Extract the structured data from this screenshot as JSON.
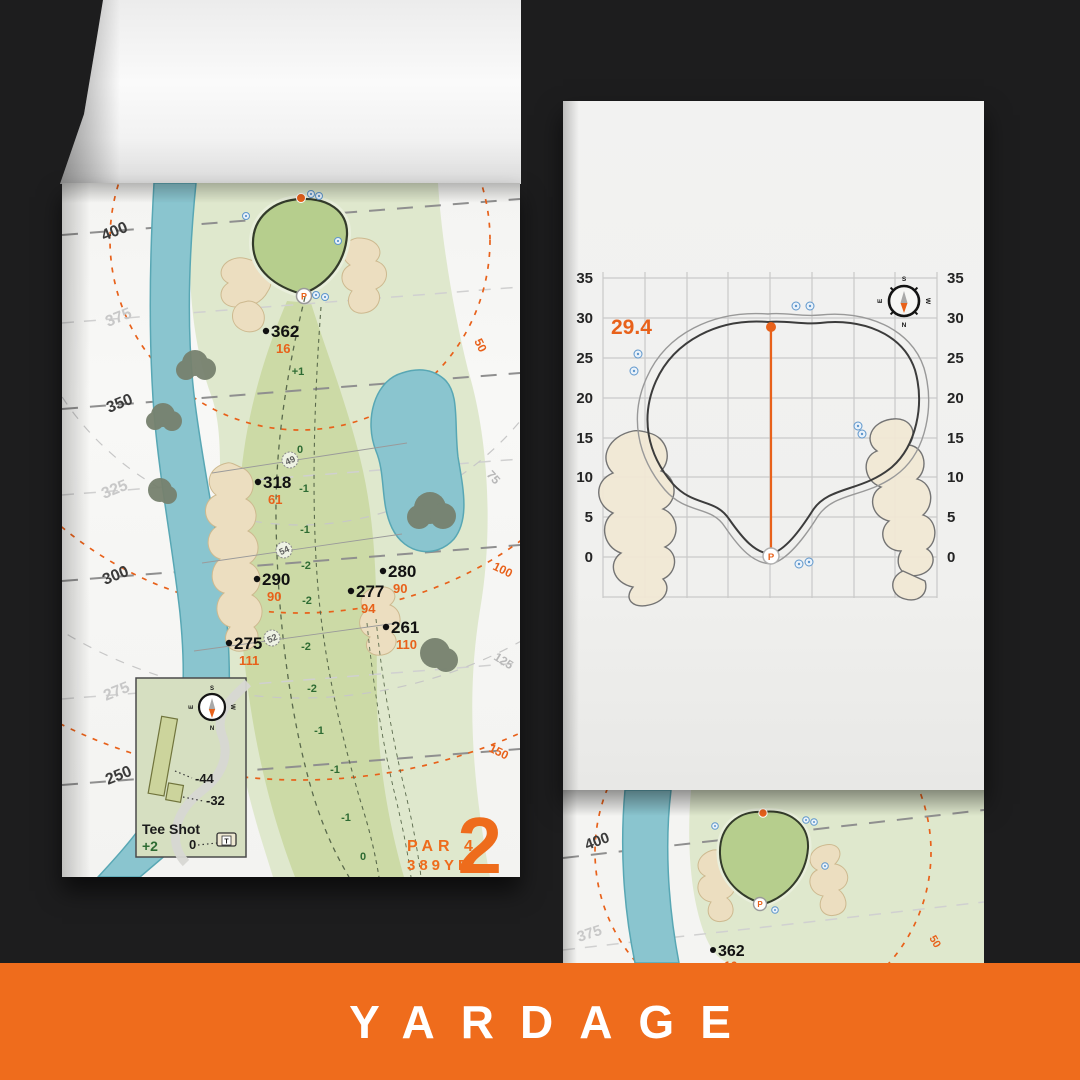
{
  "banner": {
    "title": "YARDAGE"
  },
  "palette": {
    "accent_orange": "#ee6c1c",
    "paper": "#f4f4f2",
    "fairway": "#ccdaa6",
    "rough": "#dfe8cd",
    "green": "#b6ce8d",
    "water": "#8ac5cf",
    "bunker": "#ecdec0",
    "slope_text": "#2e6b33"
  },
  "compass": {
    "n": "N",
    "s": "S",
    "e": "E",
    "w": "W"
  },
  "glyphs": {
    "pin": "P",
    "tee": "T"
  },
  "hole_page": {
    "side_yardages": [
      {
        "label": "400"
      },
      {
        "label": "375"
      },
      {
        "label": "350"
      },
      {
        "label": "325"
      },
      {
        "label": "300"
      },
      {
        "label": "275"
      },
      {
        "label": "250"
      }
    ],
    "arc_labels": [
      {
        "label": "50"
      },
      {
        "label": "75"
      },
      {
        "label": "100"
      },
      {
        "label": "125"
      },
      {
        "label": "150"
      }
    ],
    "markers": [
      {
        "dist": "362",
        "sub": "16"
      },
      {
        "dist": "318",
        "sub": "61"
      },
      {
        "dist": "290",
        "sub": "90"
      },
      {
        "dist": "275",
        "sub": "111"
      },
      {
        "dist": "280",
        "sub": "90"
      },
      {
        "dist": "277",
        "sub": "94"
      },
      {
        "dist": "261",
        "sub": "110"
      }
    ],
    "checkpoints": [
      "49",
      "54",
      "52"
    ],
    "slopes": [
      "+1",
      "0",
      "-1",
      "-1",
      "-2",
      "-2",
      "-2",
      "-2",
      "-1",
      "-1",
      "-1",
      "0"
    ],
    "hole_info": {
      "par": "PAR 4",
      "yards": "389YD",
      "number": "2"
    },
    "tee_inset": {
      "title": "Tee Shot",
      "score": "+2",
      "zero": "0",
      "offset_long": "-44",
      "offset_short": "-32"
    }
  },
  "green_page": {
    "measurement": "29.4",
    "ticks": [
      "35",
      "30",
      "25",
      "20",
      "15",
      "10",
      "5",
      "0"
    ]
  },
  "preview_page": {
    "marker": {
      "dist": "362",
      "sub": "16"
    },
    "yardages": [
      "400",
      "375"
    ],
    "arc_label": "50"
  }
}
